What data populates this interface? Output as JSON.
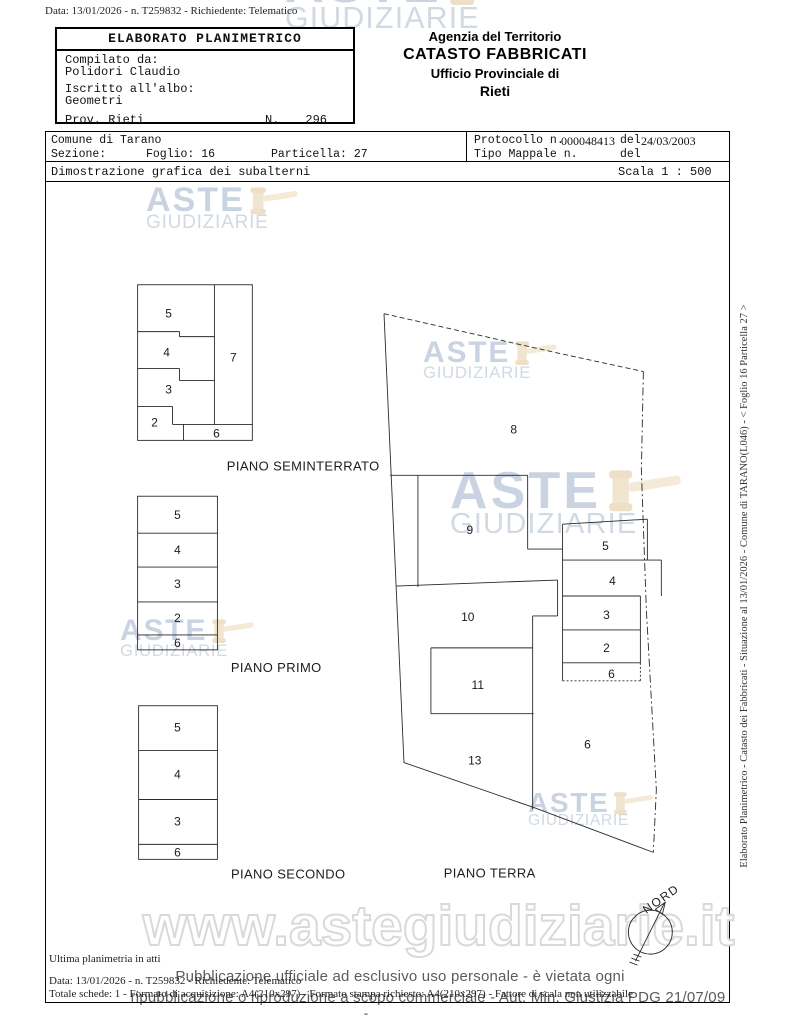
{
  "page": {
    "top_line": "Data: 13/01/2026 - n. T259832 - Richiedente: Telematico"
  },
  "elaborato_box": {
    "title": "ELABORATO PLANIMETRICO",
    "compilato_label": "Compilato da:",
    "compilato_value": "Polidori Claudio",
    "iscritto_label": "Iscritto all'albo:",
    "iscritto_value": "Geometri",
    "prov_label": "Prov. Rieti",
    "n_label": "N.",
    "n_value": "296"
  },
  "agency": {
    "line1": "Agenzia del Territorio",
    "line2": "CATASTO FABBRICATI",
    "line3": "Ufficio Provinciale di",
    "line4": "Rieti"
  },
  "info": {
    "comune": "Comune di Tarano",
    "sezione_label": "Sezione:",
    "foglio": "Foglio: 16",
    "particella": "Particella: 27",
    "protocollo_label": "Protocollo n.",
    "protocollo_value": "000048413",
    "del1_label": "del",
    "del1_value": "24/03/2003",
    "tipo_mappale_label": "Tipo Mappale n.",
    "del2_label": "del"
  },
  "dimostrazione": {
    "left": "Dimostrazione grafica dei subalterni",
    "scala": "Scala 1 : 500"
  },
  "plans": {
    "seminterrato": {
      "title": "PIANO SEMINTERRATO",
      "rooms": [
        "5",
        "4",
        "3",
        "2",
        "7",
        "6"
      ]
    },
    "primo": {
      "title": "PIANO PRIMO",
      "rooms": [
        "5",
        "4",
        "3",
        "2",
        "6"
      ]
    },
    "secondo": {
      "title": "PIANO SECONDO",
      "rooms": [
        "5",
        "4",
        "3",
        "6"
      ]
    },
    "terra": {
      "title": "PIANO TERRA",
      "rooms": [
        "8",
        "9",
        "10",
        "11",
        "13",
        "6"
      ],
      "stack": [
        "5",
        "4",
        "3",
        "2",
        "6"
      ]
    }
  },
  "compass": {
    "label": "NORD"
  },
  "watermark": {
    "line1": "ASTE",
    "line2": "GIUDIZIARIE",
    "url": "www.astegiudiziarie.it"
  },
  "footer": {
    "ultima": "Ultima planimetria in atti",
    "data_line": "Data: 13/01/2026 - n. T259832 - Richiedente: Telematico",
    "totale": "Totale schede: 1 - Formato di acquisizione: A4(210x297) - Formato stampa richiesto: A4(210x297) - Fattore di scala non utilizzabile",
    "page_dash": "-"
  },
  "overlay": {
    "line1": "Pubblicazione ufficiale ad esclusivo uso personale - è vietata ogni",
    "line2": "ripubblicazione o riproduzione a scopo commerciale - Aut. Min. Giustizia PDG 21/07/09"
  },
  "side_caption": "Elaborato Planimetrico - Catasto dei Fabbricati - Situazione al 13/01/2026 - Comune di TARANO(L046) - < Foglio 16 Particella 27 >"
}
